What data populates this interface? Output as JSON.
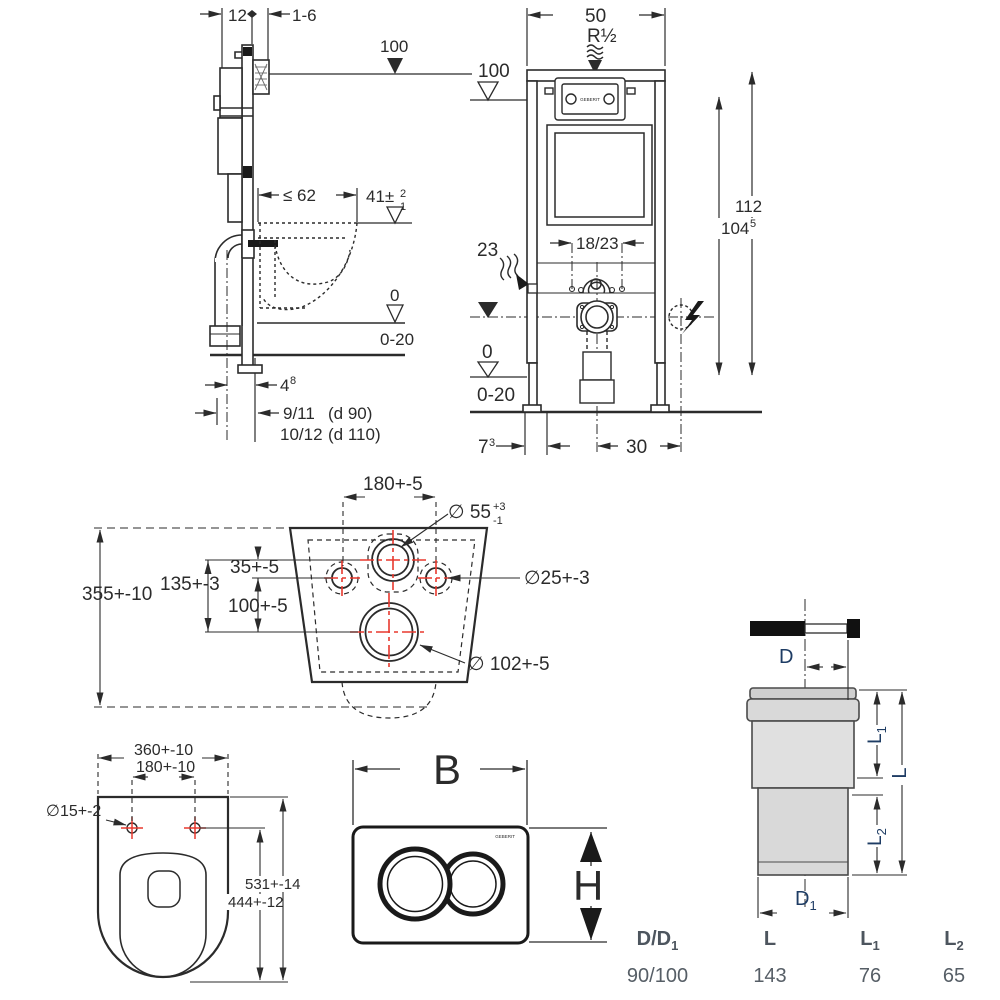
{
  "side_view": {
    "depth": "12",
    "wall_gap": "1-6",
    "level_top": "100",
    "bowl_depth": "≤ 62",
    "bowl_h": "41±",
    "bowl_h_sup": "2",
    "bowl_h_sub": "1",
    "zero": "0",
    "floor_range": "0-20",
    "offset": "4",
    "offset_sup": "8",
    "drain_a": "9/11",
    "drain_a_note": "(d 90)",
    "drain_b": "10/12",
    "drain_b_note": "(d 110)"
  },
  "front_view": {
    "width": "50",
    "inlet": "R½",
    "level_top": "100",
    "height_total": "112",
    "height_plate": "104",
    "height_plate_sup": "5",
    "supply_range": "18/23",
    "drain_h": "23",
    "zero": "0",
    "floor_range": "0-20",
    "side_off": "7",
    "side_off_sup": "3",
    "elec_off": "30",
    "logo": "GEBERIT"
  },
  "rear_view": {
    "overall": "355+-10",
    "holes_spacing": "180+-5",
    "d55": "∅ 55",
    "d55_sup": "+3",
    "d55_sub": "-1",
    "h35": "35+-5",
    "h135": "135+-3",
    "h100": "100+-5",
    "d25": "∅25+-3",
    "d102": "∅ 102+-5"
  },
  "top_view": {
    "width": "360+-10",
    "hinge": "180+-10",
    "d15": "∅15+-2",
    "len_total": "531+-14",
    "len_holes": "444+-12"
  },
  "flush_plate": {
    "width": "B",
    "height": "H",
    "logo": "GEBERIT"
  },
  "outlet_bend": {
    "d": "D",
    "d1_main": "D",
    "d1_sub": "1",
    "l": "L",
    "l1_main": "L",
    "l1_sub": "1",
    "l2_main": "L",
    "l2_sub": "2"
  },
  "outlet_table": {
    "headers": [
      {
        "main": "D/D",
        "sub": "1"
      },
      {
        "main": "L",
        "sub": ""
      },
      {
        "main": "L",
        "sub": "1"
      },
      {
        "main": "L",
        "sub": "2"
      }
    ],
    "values": [
      "90/100",
      "143",
      "76",
      "65"
    ]
  },
  "colors": {
    "line": "#2b2b2b",
    "red_center_mark": "#e8392e",
    "label_blue": "#1e3c64",
    "pipe_fill": "#d9d9d9"
  }
}
